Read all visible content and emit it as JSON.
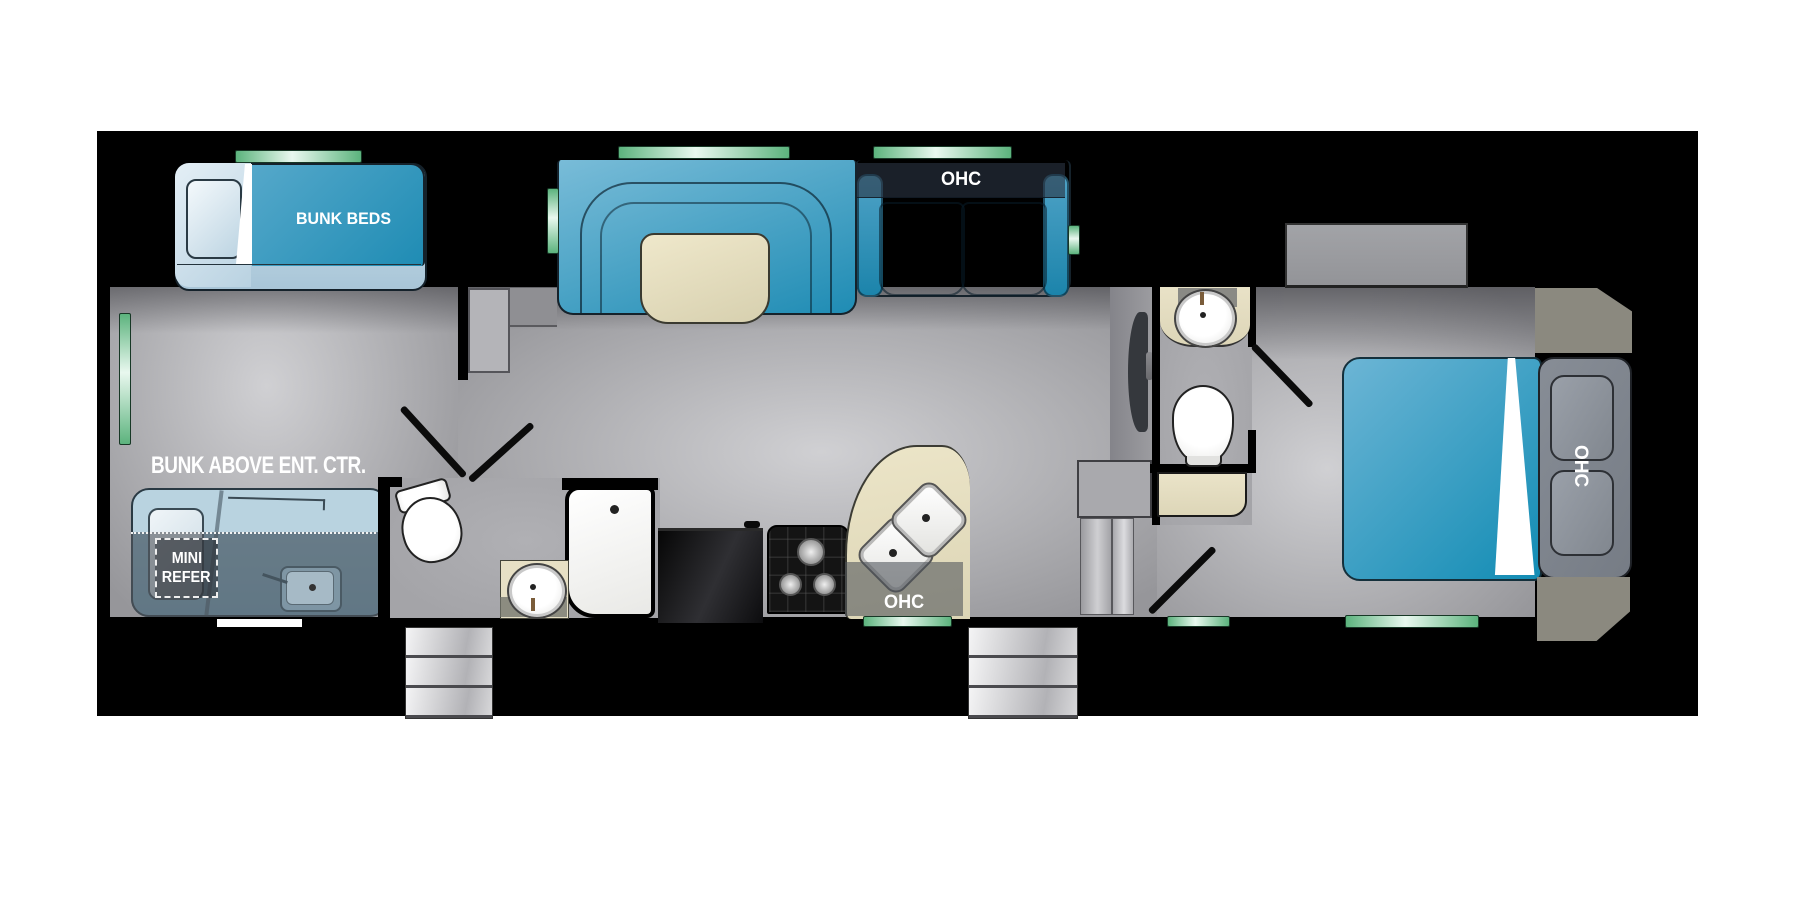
{
  "title": "RV fifth-wheel floor plan",
  "labels": {
    "bunk_beds": "BUNK BEDS",
    "bunk_above": "BUNK ABOVE ENT. CTR.",
    "mini_refer_line1": "MINI",
    "mini_refer_line2": "REFER",
    "ohc_sofa": "OHC",
    "ohc_kitchen": "OHC",
    "ohc_bedroom": "OHC"
  },
  "colors": {
    "blue_dark": "#1f8cb4",
    "blue_light": "#6fb5d4",
    "bed_blue": "#128cb4",
    "cream": "#e7e0c3",
    "floor_light": "#d0d0d3",
    "floor_dark": "#96969a",
    "bath_floor": "#a4a4a8",
    "window_green": "#5cb37d",
    "window_green_light": "#e9f8ef",
    "overlay_gray": "#52575d",
    "cap_gray": "#8b897f",
    "wall_black": "#000000"
  }
}
